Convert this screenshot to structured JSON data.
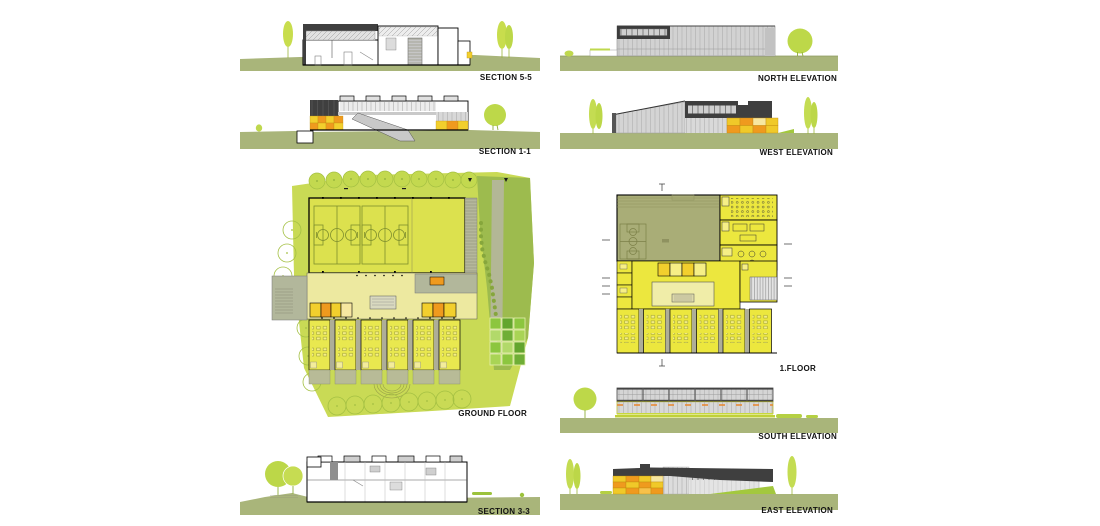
{
  "sheet": {
    "background": "#ffffff",
    "width": 1100,
    "height": 526
  },
  "palette": {
    "site_green": "#c9da55",
    "landscape_green": "#9dbb4e",
    "court_yellow": "#dce14e",
    "room_yellow": "#e9e84f",
    "pale_hall_yellow": "#ede9a0",
    "khaki_hall": "#a9ad77",
    "ground_olive": "#a9b57a",
    "tree_green": "#bcd748",
    "dark_facade_gray": "#3f3f3f",
    "light_facade_gray": "#d2d2d2",
    "service_gray": "#b2b79b",
    "orange": "#ef9a1e",
    "locker_yellow": "#f2cf2d",
    "garden_green_dark": "#63a52e",
    "garden_green_mid": "#8cc63f",
    "garden_green_light": "#b2d96a",
    "label_color": "#111111"
  },
  "drawings": [
    {
      "id": "section-5-5",
      "label": "SECTION 5-5",
      "type": "building-section"
    },
    {
      "id": "north-elevation",
      "label": "NORTH ELEVATION",
      "type": "elevation"
    },
    {
      "id": "section-1-1",
      "label": "SECTION 1-1",
      "type": "building-section"
    },
    {
      "id": "west-elevation",
      "label": "WEST ELEVATION",
      "type": "elevation"
    },
    {
      "id": "ground-floor",
      "label": "GROUND FLOOR",
      "type": "floor-plan"
    },
    {
      "id": "first-floor",
      "label": "1.FLOOR",
      "type": "floor-plan"
    },
    {
      "id": "south-elevation",
      "label": "SOUTH ELEVATION",
      "type": "elevation"
    },
    {
      "id": "section-3-3",
      "label": "SECTION 3-3",
      "type": "building-section"
    },
    {
      "id": "east-elevation",
      "label": "EAST ELEVATION",
      "type": "elevation"
    }
  ]
}
